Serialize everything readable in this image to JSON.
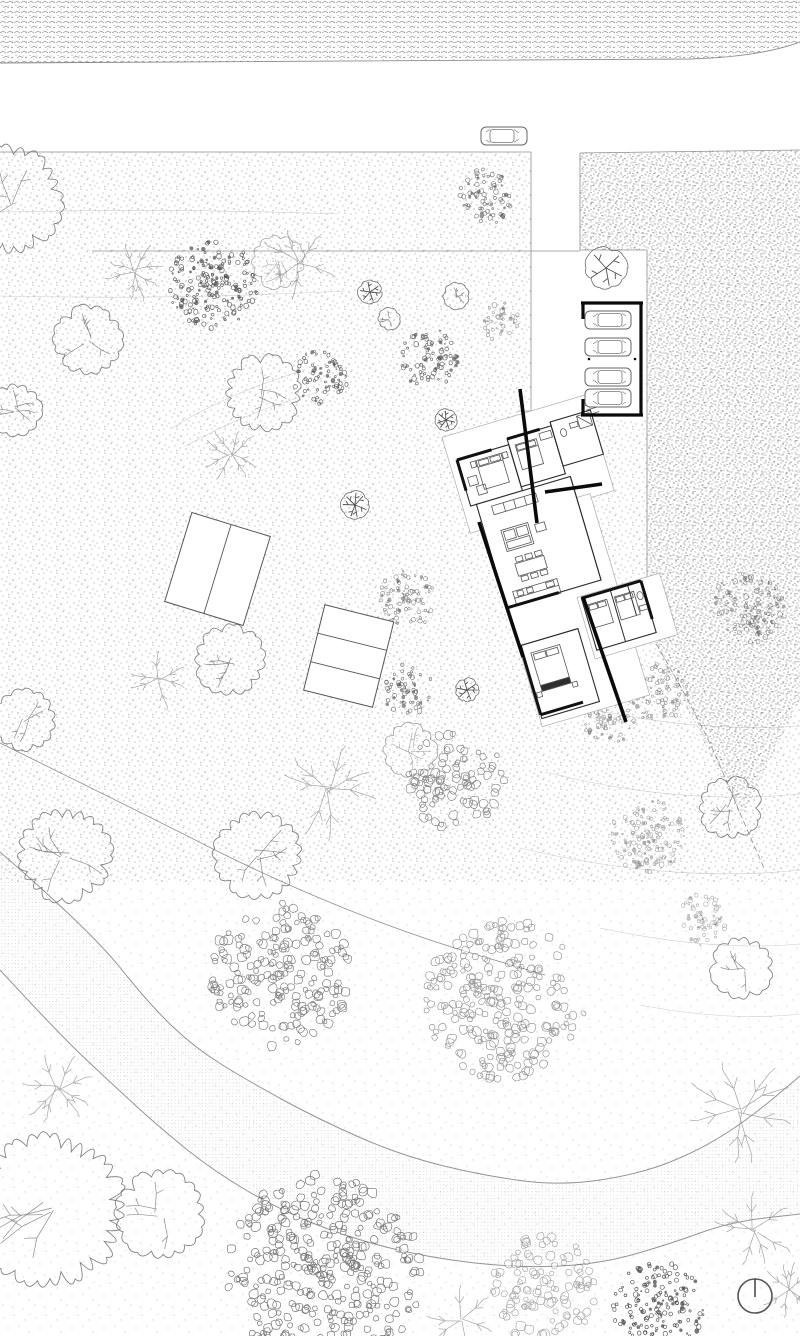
{
  "canvas": {
    "width": 800,
    "height": 1336
  },
  "palette": {
    "paper": "#ffffff",
    "ink": "#0a0a0a",
    "wall": "#111111",
    "room_line": "#2b2b2b",
    "furn_line": "#555555",
    "podium_line": "#b5b5b5",
    "edge_line": "#8f8f8f",
    "tree_line": "#6e6e6e",
    "faint": "#9a9a9a"
  },
  "top_band": {
    "fill_shape": "M0,0 H800 V42 Q760,57 690,59 L0,63 Z",
    "bottom_edge": "M0,63 L690,59 Q760,57 800,42"
  },
  "fields": {
    "medium": {
      "x": 0,
      "y": 152,
      "w": 800,
      "h": 730
    },
    "sparse": {
      "x": 0,
      "y": 882,
      "w": 800,
      "h": 454
    },
    "dense_polygon": [
      [
        580,
        153
      ],
      [
        800,
        150
      ],
      [
        800,
        700
      ],
      [
        742,
        818
      ],
      [
        647,
        628
      ],
      [
        647,
        250
      ],
      [
        580,
        250
      ]
    ],
    "driveway_white": {
      "x": 531,
      "y": 152,
      "w": 49,
      "h": 262
    },
    "carport_bay_white": {
      "x": 580,
      "y": 250,
      "w": 67,
      "h": 170
    }
  },
  "edges": [
    [
      0,
      152,
      531,
      152
    ],
    [
      531,
      152,
      531,
      413
    ],
    [
      531,
      413,
      580,
      413
    ],
    [
      580,
      153,
      580,
      250
    ],
    [
      580,
      250,
      647,
      250
    ],
    [
      647,
      250,
      647,
      628
    ],
    [
      580,
      153,
      800,
      150
    ],
    [
      92,
      251,
      580,
      251
    ],
    [
      518,
      411,
      553,
      411
    ],
    [
      518,
      418,
      553,
      418
    ]
  ],
  "property_left": [
    [
      0,
      743
    ],
    [
      140,
      812
    ],
    [
      270,
      878
    ],
    [
      410,
      935
    ],
    [
      545,
      975
    ]
  ],
  "property_right": [
    [
      647,
      628
    ],
    [
      700,
      718
    ],
    [
      742,
      818
    ],
    [
      764,
      868
    ]
  ],
  "contours": [
    "M0,212 Q170,208 338,214",
    "M0,296 Q170,300 345,291",
    "M172,428 Q225,395 298,372",
    "M186,446 Q245,412 318,392",
    "M560,702 Q690,734 800,726",
    "M545,772 Q680,806 800,794",
    "M520,848 Q672,884 800,870",
    "M600,928 Q712,952 800,944",
    "M640,1005 Q730,1022 800,1014"
  ],
  "path_band": {
    "upper": [
      [
        0,
        852
      ],
      [
        90,
        930
      ],
      [
        150,
        1005
      ],
      [
        195,
        1048
      ],
      [
        250,
        1082
      ],
      [
        320,
        1120
      ],
      [
        400,
        1155
      ],
      [
        480,
        1175
      ],
      [
        560,
        1186
      ],
      [
        640,
        1174
      ],
      [
        700,
        1150
      ],
      [
        750,
        1118
      ],
      [
        800,
        1076
      ]
    ],
    "lower": [
      [
        0,
        970
      ],
      [
        60,
        1035
      ],
      [
        110,
        1082
      ],
      [
        160,
        1128
      ],
      [
        215,
        1172
      ],
      [
        280,
        1210
      ],
      [
        350,
        1238
      ],
      [
        430,
        1258
      ],
      [
        520,
        1268
      ],
      [
        600,
        1264
      ],
      [
        670,
        1244
      ],
      [
        730,
        1222
      ],
      [
        800,
        1214
      ]
    ]
  },
  "carport": {
    "frame": [
      [
        581,
        303,
        643,
        303
      ],
      [
        641,
        303,
        641,
        415
      ],
      [
        581,
        415,
        643,
        415
      ],
      [
        583,
        303,
        583,
        319
      ],
      [
        583,
        399,
        583,
        415
      ]
    ],
    "posts": [
      [
        589,
        359
      ],
      [
        635,
        359
      ]
    ],
    "cars": [
      {
        "x": 608,
        "y": 320,
        "flip": true
      },
      {
        "x": 608,
        "y": 347,
        "flip": true
      },
      {
        "x": 608,
        "y": 377,
        "flip": true
      },
      {
        "x": 608,
        "y": 398,
        "flip": true
      }
    ]
  },
  "road_car": {
    "x": 504,
    "y": 136,
    "flip": false
  },
  "panels": [
    {
      "cx": 217.5,
      "cy": 569,
      "w": 82,
      "h": 93,
      "angle": 17,
      "split": "v",
      "parts": 2
    },
    {
      "cx": 348.7,
      "cy": 656,
      "w": 71,
      "h": 88,
      "angle": 14,
      "split": "h",
      "parts": 3
    }
  ],
  "trees": [
    {
      "t": "scallop",
      "x": 8,
      "y": 200,
      "r": 52
    },
    {
      "t": "scallop",
      "x": 15,
      "y": 410,
      "r": 26
    },
    {
      "t": "branch",
      "x": 135,
      "y": 272,
      "r": 30
    },
    {
      "t": "branch",
      "x": 300,
      "y": 263,
      "r": 40
    },
    {
      "t": "dense",
      "x": 213,
      "y": 285,
      "r": 45,
      "o": 0.85
    },
    {
      "t": "scallop",
      "x": 278,
      "y": 262,
      "r": 26,
      "o": 0.55
    },
    {
      "t": "dense",
      "x": 485,
      "y": 197,
      "r": 28,
      "o": 0.7
    },
    {
      "t": "star",
      "x": 606,
      "y": 268,
      "r": 21
    },
    {
      "t": "scallop",
      "x": 88,
      "y": 340,
      "r": 33
    },
    {
      "t": "star",
      "x": 370,
      "y": 292,
      "r": 12
    },
    {
      "t": "scallop",
      "x": 389,
      "y": 319,
      "r": 11
    },
    {
      "t": "scallop",
      "x": 456,
      "y": 296,
      "r": 13
    },
    {
      "t": "dense",
      "x": 500,
      "y": 322,
      "r": 20,
      "o": 0.5
    },
    {
      "t": "dense",
      "x": 320,
      "y": 377,
      "r": 28,
      "o": 0.8
    },
    {
      "t": "dense",
      "x": 428,
      "y": 358,
      "r": 30,
      "o": 0.8
    },
    {
      "t": "scallop",
      "x": 263,
      "y": 393,
      "r": 37
    },
    {
      "t": "star",
      "x": 446,
      "y": 420,
      "r": 11
    },
    {
      "t": "branch",
      "x": 230,
      "y": 455,
      "r": 28
    },
    {
      "t": "star",
      "x": 355,
      "y": 505,
      "r": 14
    },
    {
      "t": "dense",
      "x": 408,
      "y": 600,
      "r": 30,
      "o": 0.6
    },
    {
      "t": "scallop",
      "x": 230,
      "y": 660,
      "r": 34
    },
    {
      "t": "branch",
      "x": 160,
      "y": 680,
      "r": 30
    },
    {
      "t": "dense",
      "x": 408,
      "y": 690,
      "r": 26,
      "o": 0.7
    },
    {
      "t": "star",
      "x": 467,
      "y": 690,
      "r": 12
    },
    {
      "t": "scallop",
      "x": 25,
      "y": 720,
      "r": 30
    },
    {
      "t": "dense",
      "x": 608,
      "y": 720,
      "r": 26,
      "o": 0.5
    },
    {
      "t": "scallop",
      "x": 410,
      "y": 750,
      "r": 26,
      "o": 0.6
    },
    {
      "t": "dense",
      "x": 748,
      "y": 608,
      "r": 36,
      "o": 0.55
    },
    {
      "t": "dense",
      "x": 658,
      "y": 692,
      "r": 30,
      "o": 0.5
    },
    {
      "t": "leaf",
      "x": 455,
      "y": 782,
      "r": 50,
      "o": 0.7
    },
    {
      "t": "branch",
      "x": 330,
      "y": 790,
      "r": 52
    },
    {
      "t": "scallop",
      "x": 65,
      "y": 855,
      "r": 45
    },
    {
      "t": "scallop",
      "x": 258,
      "y": 855,
      "r": 42
    },
    {
      "t": "dense",
      "x": 648,
      "y": 838,
      "r": 38,
      "o": 0.45
    },
    {
      "t": "scallop",
      "x": 730,
      "y": 808,
      "r": 30
    },
    {
      "t": "dense",
      "x": 700,
      "y": 920,
      "r": 26,
      "o": 0.4
    },
    {
      "t": "leaf",
      "x": 280,
      "y": 975,
      "r": 72,
      "o": 0.75
    },
    {
      "t": "leaf",
      "x": 505,
      "y": 1000,
      "r": 80,
      "o": 0.6
    },
    {
      "t": "scallop",
      "x": 742,
      "y": 968,
      "r": 30
    },
    {
      "t": "branch",
      "x": 58,
      "y": 1088,
      "r": 38
    },
    {
      "t": "branch",
      "x": 740,
      "y": 1110,
      "r": 55
    },
    {
      "t": "scallop",
      "x": 160,
      "y": 1214,
      "r": 42
    },
    {
      "t": "scallop",
      "x": 50,
      "y": 1210,
      "r": 72
    },
    {
      "t": "leaf",
      "x": 325,
      "y": 1270,
      "r": 98,
      "o": 0.8
    },
    {
      "t": "branch",
      "x": 755,
      "y": 1230,
      "r": 40
    },
    {
      "t": "leaf",
      "x": 545,
      "y": 1290,
      "r": 54,
      "o": 0.5
    },
    {
      "t": "dense",
      "x": 658,
      "y": 1308,
      "r": 46,
      "o": 0.9
    },
    {
      "t": "branch",
      "x": 460,
      "y": 1320,
      "r": 36
    },
    {
      "t": "branch",
      "x": 788,
      "y": 1290,
      "r": 28
    }
  ],
  "house": {
    "origin": [
      457,
      460
    ],
    "angle": -16.5,
    "podiums": [
      [
        -8,
        -26,
        150,
        100
      ],
      [
        6,
        70,
        112,
        210
      ],
      [
        76,
        166,
        86,
        64
      ]
    ],
    "rooms": [
      [
        0,
        0,
        54,
        48
      ],
      [
        54,
        -6,
        46,
        50
      ],
      [
        100,
        -10,
        42,
        46
      ],
      [
        6,
        48,
        98,
        108
      ],
      [
        80,
        168,
        62,
        54
      ],
      [
        8,
        196,
        60,
        76
      ]
    ],
    "thin_walls": [
      [
        104,
        48,
        104,
        156
      ],
      [
        54,
        0,
        54,
        44
      ],
      [
        100,
        -10,
        100,
        36
      ],
      [
        8,
        196,
        68,
        196
      ],
      [
        110,
        168,
        110,
        222
      ],
      [
        128,
        168,
        128,
        200
      ]
    ],
    "thick_walls_local": [
      [
        0,
        0,
        36,
        0
      ],
      [
        0,
        0,
        0,
        32
      ],
      [
        54,
        -6,
        88,
        -6
      ],
      [
        6,
        156,
        60,
        156
      ],
      [
        80,
        168,
        142,
        168
      ],
      [
        142,
        168,
        142,
        208
      ],
      [
        8,
        196,
        8,
        268
      ],
      [
        8,
        268,
        52,
        268
      ]
    ],
    "furniture": [
      {
        "k": "r",
        "x": 18,
        "y": 6,
        "w": 26,
        "h": 30
      },
      {
        "k": "l",
        "x1": 18,
        "y1": 13,
        "x2": 44,
        "y2": 13
      },
      {
        "k": "r",
        "x": 20,
        "y": 7,
        "w": 10,
        "h": 5
      },
      {
        "k": "r",
        "x": 32,
        "y": 7,
        "w": 10,
        "h": 5
      },
      {
        "k": "r",
        "x": 12,
        "y": 6,
        "w": 5,
        "h": 6
      },
      {
        "k": "r",
        "x": 45,
        "y": 6,
        "w": 5,
        "h": 6
      },
      {
        "k": "r",
        "x": 5,
        "y": 20,
        "w": 9,
        "h": 9
      },
      {
        "k": "r",
        "x": 11,
        "y": 31,
        "w": 9,
        "h": 9
      },
      {
        "k": "r",
        "x": 60,
        "y": 2,
        "w": 22,
        "h": 26
      },
      {
        "k": "l",
        "x1": 60,
        "y1": 9,
        "x2": 82,
        "y2": 9
      },
      {
        "k": "r",
        "x": 61,
        "y": 3,
        "w": 9,
        "h": 5
      },
      {
        "k": "r",
        "x": 71,
        "y": 3,
        "w": 9,
        "h": 5
      },
      {
        "k": "r",
        "x": 86,
        "y": -2,
        "w": 12,
        "h": 7
      },
      {
        "k": "e",
        "cx": 110,
        "cy": 4,
        "rx": 3,
        "ry": 4
      },
      {
        "k": "r",
        "x": 118,
        "y": -3,
        "w": 8,
        "h": 5
      },
      {
        "k": "r",
        "x": 127,
        "y": -8,
        "w": 13,
        "h": 13
      },
      {
        "k": "l",
        "x1": 127,
        "y1": -8,
        "x2": 140,
        "y2": 5
      },
      {
        "k": "r",
        "x": 20,
        "y": 54,
        "w": 46,
        "h": 9
      },
      {
        "k": "l",
        "x1": 32,
        "y1": 54,
        "x2": 32,
        "y2": 63
      },
      {
        "k": "l",
        "x1": 43,
        "y1": 54,
        "x2": 43,
        "y2": 63
      },
      {
        "k": "l",
        "x1": 54,
        "y1": 54,
        "x2": 54,
        "y2": 63
      },
      {
        "k": "r",
        "x": 22,
        "y": 80,
        "w": 28,
        "h": 22
      },
      {
        "k": "r",
        "x": 24,
        "y": 82,
        "w": 11,
        "h": 9
      },
      {
        "k": "r",
        "x": 37,
        "y": 82,
        "w": 11,
        "h": 9
      },
      {
        "k": "r",
        "x": 24,
        "y": 93,
        "w": 24,
        "h": 7
      },
      {
        "k": "r",
        "x": 56,
        "y": 84,
        "w": 10,
        "h": 8
      },
      {
        "k": "r",
        "x": 26,
        "y": 116,
        "w": 30,
        "h": 13
      },
      {
        "k": "r",
        "x": 28,
        "y": 110,
        "w": 7,
        "h": 5
      },
      {
        "k": "r",
        "x": 38,
        "y": 110,
        "w": 7,
        "h": 5
      },
      {
        "k": "r",
        "x": 48,
        "y": 110,
        "w": 7,
        "h": 5
      },
      {
        "k": "r",
        "x": 28,
        "y": 130,
        "w": 7,
        "h": 5
      },
      {
        "k": "r",
        "x": 38,
        "y": 130,
        "w": 7,
        "h": 5
      },
      {
        "k": "r",
        "x": 48,
        "y": 130,
        "w": 7,
        "h": 5
      },
      {
        "k": "r",
        "x": 16,
        "y": 142,
        "w": 46,
        "h": 15
      },
      {
        "k": "l",
        "x1": 16,
        "y1": 149,
        "x2": 62,
        "y2": 149
      },
      {
        "k": "r",
        "x": 20,
        "y": 143,
        "w": 6,
        "h": 5
      },
      {
        "k": "r",
        "x": 30,
        "y": 143,
        "w": 6,
        "h": 5
      },
      {
        "k": "r",
        "x": 50,
        "y": 143,
        "w": 8,
        "h": 5
      },
      {
        "k": "r",
        "x": 84,
        "y": 176,
        "w": 20,
        "h": 24
      },
      {
        "k": "r",
        "x": 85,
        "y": 177,
        "w": 8,
        "h": 5
      },
      {
        "k": "r",
        "x": 94,
        "y": 177,
        "w": 8,
        "h": 5
      },
      {
        "k": "r",
        "x": 112,
        "y": 176,
        "w": 20,
        "h": 24
      },
      {
        "k": "r",
        "x": 113,
        "y": 177,
        "w": 8,
        "h": 5
      },
      {
        "k": "r",
        "x": 122,
        "y": 177,
        "w": 8,
        "h": 5
      },
      {
        "k": "e",
        "cx": 137,
        "cy": 182,
        "rx": 3,
        "ry": 4
      },
      {
        "k": "r",
        "x": 133,
        "y": 192,
        "w": 8,
        "h": 5
      },
      {
        "k": "r",
        "x": 16,
        "y": 206,
        "w": 30,
        "h": 40
      },
      {
        "k": "r",
        "x": 18,
        "y": 208,
        "w": 12,
        "h": 6
      },
      {
        "k": "r",
        "x": 31,
        "y": 208,
        "w": 12,
        "h": 6
      },
      {
        "k": "r",
        "x": 16,
        "y": 240,
        "w": 30,
        "h": 6,
        "f": "#2e2e2e"
      },
      {
        "k": "r",
        "x": 10,
        "y": 246,
        "w": 5,
        "h": 5
      },
      {
        "k": "r",
        "x": 47,
        "y": 246,
        "w": 5,
        "h": 5
      },
      {
        "k": "l",
        "x1": 138,
        "y1": -16,
        "x2": 150,
        "y2": -16
      },
      {
        "k": "l",
        "x1": 138,
        "y1": -11,
        "x2": 150,
        "y2": -11
      },
      {
        "k": "l",
        "x1": 138,
        "y1": -6,
        "x2": 150,
        "y2": -6
      }
    ],
    "thick_walls_screen": [
      [
        520,
        389,
        537,
        523
      ],
      [
        545,
        492,
        602,
        484
      ],
      [
        479,
        522,
        523,
        657
      ],
      [
        583,
        597,
        626,
        722
      ]
    ]
  },
  "compass": {
    "cx": 755,
    "cy": 1296,
    "r": 17
  }
}
